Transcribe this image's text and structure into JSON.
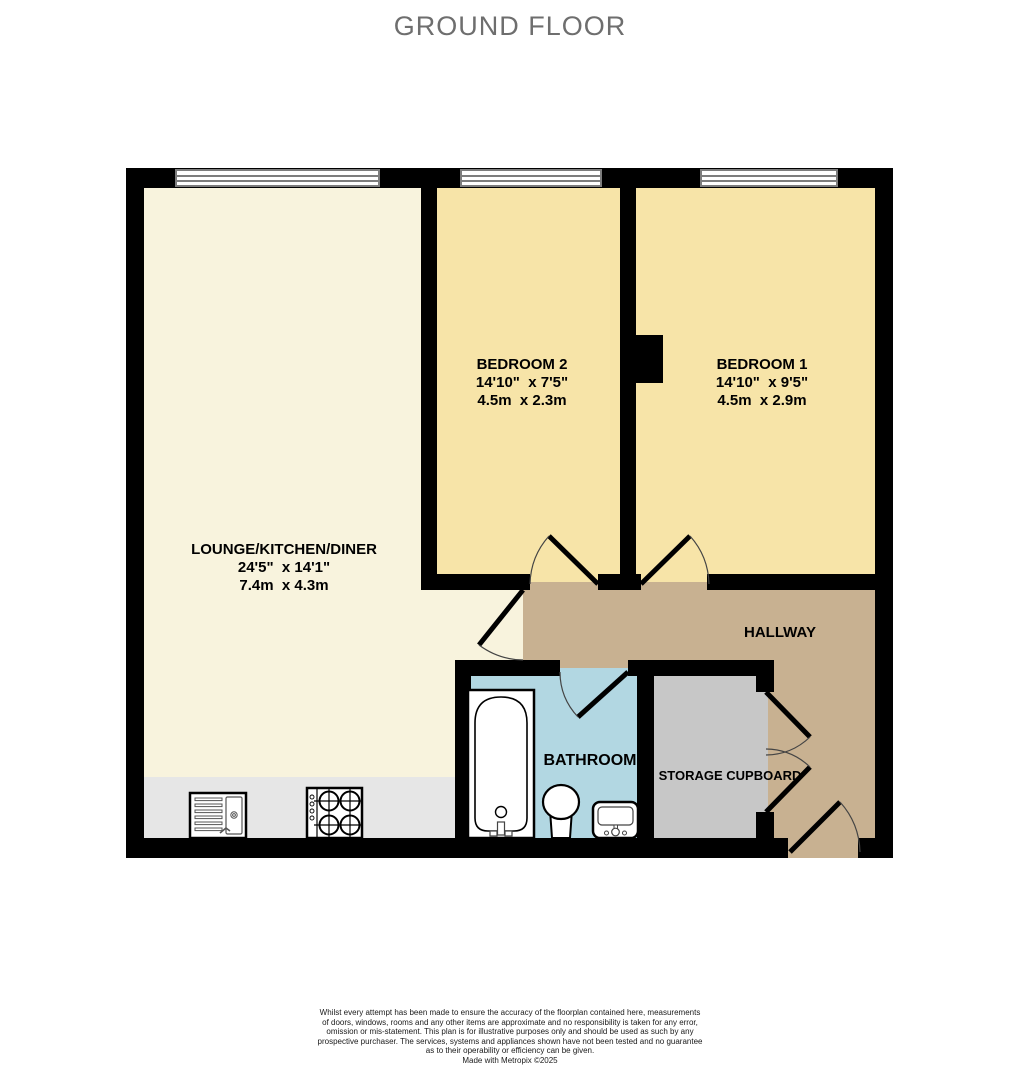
{
  "title": "GROUND FLOOR",
  "rooms": {
    "lounge": {
      "name": "LOUNGE/KITCHEN/DINER",
      "dims_imperial": "24'5\"  x 14'1\"",
      "dims_metric": "7.4m  x 4.3m",
      "floor_color": "#f8f3dd"
    },
    "bedroom2": {
      "name": "BEDROOM 2",
      "dims_imperial": "14'10\"  x 7'5\"",
      "dims_metric": "4.5m  x 2.3m",
      "floor_color": "#f7e4a8"
    },
    "bedroom1": {
      "name": "BEDROOM 1",
      "dims_imperial": "14'10\"  x 9'5\"",
      "dims_metric": "4.5m  x 2.9m",
      "floor_color": "#f7e4a8"
    },
    "hallway": {
      "name": "HALLWAY",
      "floor_color": "#c8b191"
    },
    "bathroom": {
      "name": "BATHROOM",
      "floor_color": "#b2d7e2"
    },
    "storage": {
      "name": "STORAGE CUPBOARD",
      "floor_color": "#c7c7c7"
    }
  },
  "palette": {
    "wall": "#000000",
    "kitchen_counter": "#e6e6e6",
    "title_text": "#6e6e6e",
    "label_text": "#000000",
    "window_frame": "#7d7d7d"
  },
  "footer": {
    "lines": [
      "Whilst every attempt has been made to ensure the accuracy of the floorplan contained here, measurements",
      "of doors, windows, rooms and any other items are approximate and no responsibility is taken for any error,",
      "omission or mis-statement. This plan is for illustrative purposes only and should be used as such by any",
      "prospective purchaser. The services, systems and appliances shown have not been tested and no guarantee",
      "as to their operability or efficiency can be given."
    ],
    "credit": "Made with Metropix ©2025"
  }
}
